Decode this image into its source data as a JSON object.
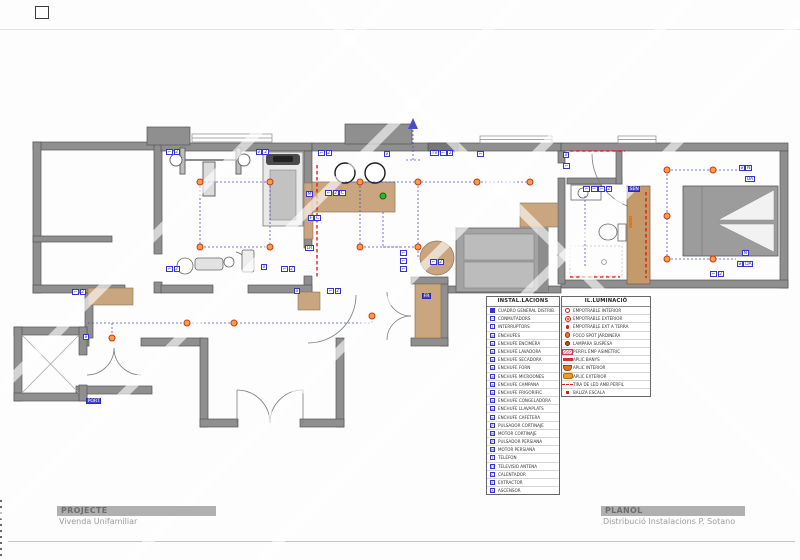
{
  "title_blocks": {
    "project_label": "PROJECTE",
    "project_value": "Vivenda Unifamiliar",
    "planol_label": "PLANOL",
    "planol_value": "Distribució Instalacions P. Sotano"
  },
  "legend_installations": {
    "title": "INSTAL.LACIONS",
    "rows": [
      {
        "icon": "cuadro-general",
        "label": "CUADRO GENERAL DISTRIB."
      },
      {
        "icon": "conmutador",
        "label": "CONMUTADORS"
      },
      {
        "icon": "interruptor",
        "label": "INTERRUPTORS"
      },
      {
        "icon": "enchufe",
        "label": "ENCHUFES"
      },
      {
        "icon": "enchufe-encimera",
        "label": "ENCHUFE ENCIMERA"
      },
      {
        "icon": "enchufe-lavadora",
        "label": "ENCHUFE LAVADORA"
      },
      {
        "icon": "enchufe-secadora",
        "label": "ENCHUFE SECADORA"
      },
      {
        "icon": "enchufe-forn",
        "label": "ENCHUFE FORN"
      },
      {
        "icon": "enchufe-microones",
        "label": "ENCHUFE MICROONES"
      },
      {
        "icon": "enchufe-campana",
        "label": "ENCHUFE CAMPANA"
      },
      {
        "icon": "enchufe-frigorific",
        "label": "ENCHUFE FRIGORIFIC"
      },
      {
        "icon": "enchufe-congeladora",
        "label": "ENCHUFE CONGELADORA"
      },
      {
        "icon": "enchufe-llavaplats",
        "label": "ENCHUFE LLAVAPLATS"
      },
      {
        "icon": "enchufe-cafetera",
        "label": "ENCHUFE CAFETERA"
      },
      {
        "icon": "pulsador-cortinaje",
        "label": "PULSADOR CORTINAJE"
      },
      {
        "icon": "motor-cortinaje",
        "label": "MOTOR CORTINAJE"
      },
      {
        "icon": "pulsador-persiana",
        "label": "PULSADOR PERSIANA"
      },
      {
        "icon": "motor-persiana",
        "label": "MOTOR PERSIANA"
      },
      {
        "icon": "telefon",
        "label": "TELEFON"
      },
      {
        "icon": "tv-antena",
        "label": "TELEVISIO ANTENA"
      },
      {
        "icon": "calentador",
        "label": "CALENTADOR"
      },
      {
        "icon": "extractor",
        "label": "EXTRACTOR"
      },
      {
        "icon": "ascensor",
        "label": "ASCENSOR"
      }
    ]
  },
  "legend_lighting": {
    "title": "IL.LUMINACIÓ",
    "rows": [
      {
        "icon": "empotrable-interior",
        "label": "EMPOTRABLE INTERIOR"
      },
      {
        "icon": "empotrable-exterior",
        "label": "EMPOTRABLE EXTERIOR"
      },
      {
        "icon": "empotrable-terra",
        "label": "EMPOTRABLE EXT A TERRA"
      },
      {
        "icon": "foco-spot",
        "label": "FOCO SPOT JARDINERA"
      },
      {
        "icon": "lampara-suspesa",
        "label": "LAMPARA SUSPESA"
      },
      {
        "icon": "perfil-asimetric",
        "label": "PERFIL EMP ASIMETRIC"
      },
      {
        "icon": "aplic-banys",
        "label": "APLIC BANYS"
      },
      {
        "icon": "aplic-interior",
        "label": "APLIC INTERIOR"
      },
      {
        "icon": "aplic-exterior",
        "label": "APLIC EXTERIOR"
      },
      {
        "icon": "tira-led",
        "label": "TIRA DE LED AMB PERFIL"
      },
      {
        "icon": "baliza",
        "label": "BALIZA ESCALA"
      }
    ]
  },
  "plan": {
    "labels": [
      {
        "x": 166,
        "y": 149,
        "parts": [
          "sw",
          "2"
        ]
      },
      {
        "x": 256,
        "y": 149,
        "parts": [
          "plug",
          "2"
        ]
      },
      {
        "x": 166,
        "y": 266,
        "parts": [
          "sw",
          "2"
        ]
      },
      {
        "x": 261,
        "y": 264,
        "parts": [
          "plug"
        ]
      },
      {
        "x": 281,
        "y": 266,
        "parts": [
          "sw",
          "2"
        ]
      },
      {
        "x": 318,
        "y": 150,
        "parts": [
          "sw",
          "2"
        ]
      },
      {
        "x": 384,
        "y": 151,
        "parts": [
          "plug"
        ]
      },
      {
        "x": 430,
        "y": 150,
        "parts": [
          "TV",
          "sw",
          "2"
        ]
      },
      {
        "x": 477,
        "y": 151,
        "parts": [
          "sw"
        ]
      },
      {
        "x": 306,
        "y": 191,
        "parts": [
          "M"
        ]
      },
      {
        "x": 325,
        "y": 190,
        "parts": [
          "sw",
          "2",
          "C"
        ]
      },
      {
        "x": 308,
        "y": 215,
        "parts": [
          "F",
          "C"
        ]
      },
      {
        "x": 305,
        "y": 245,
        "parts": [
          "LR"
        ]
      },
      {
        "x": 400,
        "y": 250,
        "parts": [
          "sw"
        ]
      },
      {
        "x": 400,
        "y": 258,
        "parts": [
          "sw"
        ]
      },
      {
        "x": 400,
        "y": 266,
        "parts": [
          "sw"
        ]
      },
      {
        "x": 430,
        "y": 259,
        "parts": [
          "sw",
          "2"
        ]
      },
      {
        "x": 583,
        "y": 186,
        "parts": [
          "sw",
          "sw",
          "sw",
          "2"
        ]
      },
      {
        "x": 628,
        "y": 186,
        "parts": [
          "SEN"
        ],
        "filled": true
      },
      {
        "x": 563,
        "y": 152,
        "parts": [
          "plug"
        ]
      },
      {
        "x": 563,
        "y": 163,
        "parts": [
          "sw"
        ]
      },
      {
        "x": 739,
        "y": 165,
        "parts": [
          "plug",
          "N"
        ]
      },
      {
        "x": 745,
        "y": 176,
        "parts": [
          "DA"
        ]
      },
      {
        "x": 742,
        "y": 250,
        "parts": [
          "N"
        ]
      },
      {
        "x": 737,
        "y": 261,
        "parts": [
          "plug",
          "DA"
        ]
      },
      {
        "x": 710,
        "y": 271,
        "parts": [
          "sw",
          "2"
        ]
      },
      {
        "x": 83,
        "y": 334,
        "parts": [
          "plug"
        ]
      },
      {
        "x": 72,
        "y": 289,
        "parts": [
          "sw",
          "2"
        ]
      },
      {
        "x": 294,
        "y": 288,
        "parts": [
          "plug"
        ]
      },
      {
        "x": 327,
        "y": 288,
        "parts": [
          "sw",
          "2"
        ]
      },
      {
        "x": 422,
        "y": 293,
        "parts": [
          "FR"
        ],
        "filled": true
      },
      {
        "x": 86,
        "y": 398,
        "parts": [
          "PORT"
        ],
        "filled": true
      }
    ],
    "lights": [
      {
        "x": 200,
        "y": 182
      },
      {
        "x": 270,
        "y": 182
      },
      {
        "x": 200,
        "y": 247
      },
      {
        "x": 270,
        "y": 247
      },
      {
        "x": 360,
        "y": 182
      },
      {
        "x": 418,
        "y": 182
      },
      {
        "x": 477,
        "y": 182
      },
      {
        "x": 530,
        "y": 182
      },
      {
        "x": 360,
        "y": 247
      },
      {
        "x": 418,
        "y": 247
      },
      {
        "x": 112,
        "y": 338
      },
      {
        "x": 187,
        "y": 323
      },
      {
        "x": 234,
        "y": 323
      },
      {
        "x": 372,
        "y": 316
      },
      {
        "x": 667,
        "y": 170
      },
      {
        "x": 713,
        "y": 170
      },
      {
        "x": 667,
        "y": 216
      },
      {
        "x": 667,
        "y": 259
      },
      {
        "x": 713,
        "y": 259
      },
      {
        "x": 383,
        "y": 196,
        "type": "green"
      }
    ]
  },
  "colors": {
    "wall": "#8f8f8f",
    "symbol_blue": "#3535cc",
    "light_orange": "#f4a04a",
    "light_ring_red": "#cc3510",
    "led_red": "#e01010",
    "furniture_tan": "#c9a67f"
  }
}
